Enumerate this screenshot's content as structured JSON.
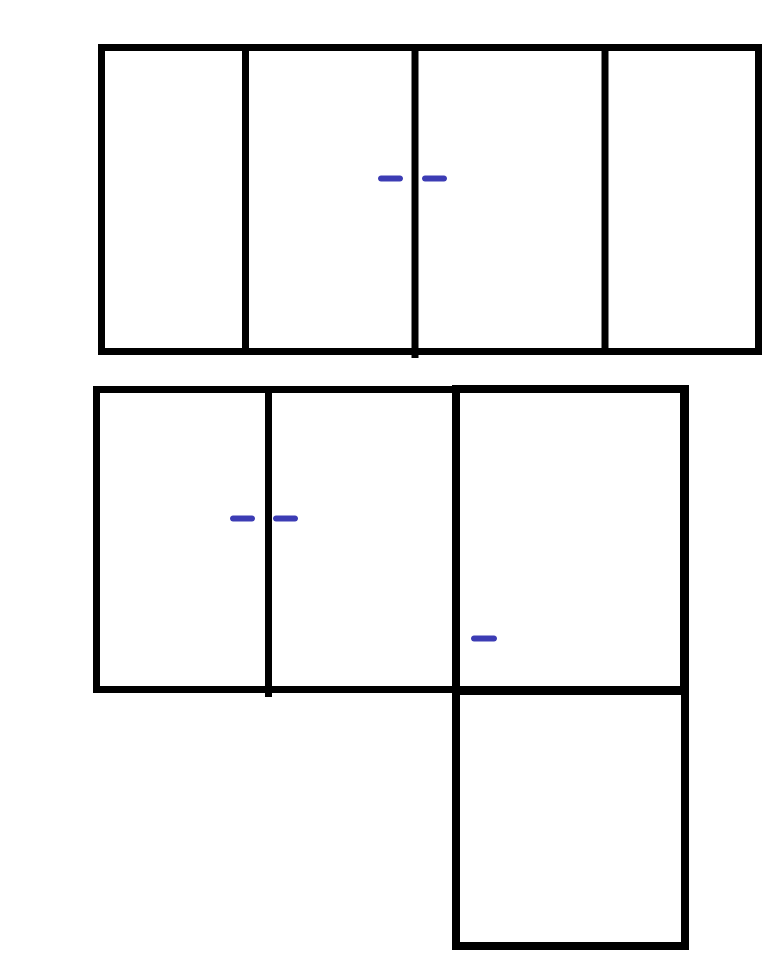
{
  "canvas": {
    "width": 768,
    "height": 978,
    "background_color": "#ffffff"
  },
  "palette": {
    "outline_color": "#000000",
    "dash_color": "#3c3cb4"
  },
  "figure": {
    "description": "Sketch of cabinet-like rectilinear outlines: a top four-panel unit, a middle three-panel unit, and a lower square attached below the right column; short blue dash marks sit beside panel dividers.",
    "shapes": [
      {
        "name": "top-cabinet-outline",
        "type": "rect",
        "x": 98,
        "y": 44,
        "width": 664,
        "height": 311,
        "stroke": "outline_color",
        "stroke_width": 7
      },
      {
        "name": "top-cabinet-divider-1",
        "type": "line",
        "x1": 245.5,
        "y1": 44,
        "x2": 245.5,
        "y2": 355,
        "stroke": "outline_color",
        "stroke_width": 7
      },
      {
        "name": "top-cabinet-divider-2",
        "type": "line",
        "x1": 415,
        "y1": 44,
        "x2": 415,
        "y2": 358,
        "stroke": "outline_color",
        "stroke_width": 7
      },
      {
        "name": "top-cabinet-divider-3",
        "type": "line",
        "x1": 605,
        "y1": 44,
        "x2": 605,
        "y2": 355,
        "stroke": "outline_color",
        "stroke_width": 7
      },
      {
        "name": "middle-cabinet-outline",
        "type": "rect",
        "x": 93,
        "y": 386,
        "width": 594,
        "height": 307,
        "stroke": "outline_color",
        "stroke_width": 7
      },
      {
        "name": "middle-cabinet-divider",
        "type": "line",
        "x1": 268.5,
        "y1": 386,
        "x2": 268.5,
        "y2": 697,
        "stroke": "outline_color",
        "stroke_width": 7
      },
      {
        "name": "right-column-outline",
        "type": "rect",
        "x": 452,
        "y": 385,
        "width": 237,
        "height": 565,
        "stroke": "outline_color",
        "stroke_width": 8
      },
      {
        "name": "right-column-shelf-divider",
        "type": "line",
        "x1": 452,
        "y1": 691,
        "x2": 689,
        "y2": 691,
        "stroke": "outline_color",
        "stroke_width": 8
      },
      {
        "name": "handle-dash-top-left",
        "type": "line",
        "x1": 381,
        "y1": 178.5,
        "x2": 400,
        "y2": 178.5,
        "stroke": "dash_color",
        "stroke_width": 6,
        "cap": "round"
      },
      {
        "name": "handle-dash-top-right",
        "type": "line",
        "x1": 425,
        "y1": 178.5,
        "x2": 444,
        "y2": 178.5,
        "stroke": "dash_color",
        "stroke_width": 6,
        "cap": "round"
      },
      {
        "name": "handle-dash-middle-left",
        "type": "line",
        "x1": 233,
        "y1": 518.5,
        "x2": 252,
        "y2": 518.5,
        "stroke": "dash_color",
        "stroke_width": 6,
        "cap": "round"
      },
      {
        "name": "handle-dash-middle-right",
        "type": "line",
        "x1": 276,
        "y1": 518.5,
        "x2": 295,
        "y2": 518.5,
        "stroke": "dash_color",
        "stroke_width": 6,
        "cap": "round"
      },
      {
        "name": "handle-dash-right-column",
        "type": "line",
        "x1": 474,
        "y1": 638.5,
        "x2": 494,
        "y2": 638.5,
        "stroke": "dash_color",
        "stroke_width": 6,
        "cap": "round"
      }
    ]
  }
}
